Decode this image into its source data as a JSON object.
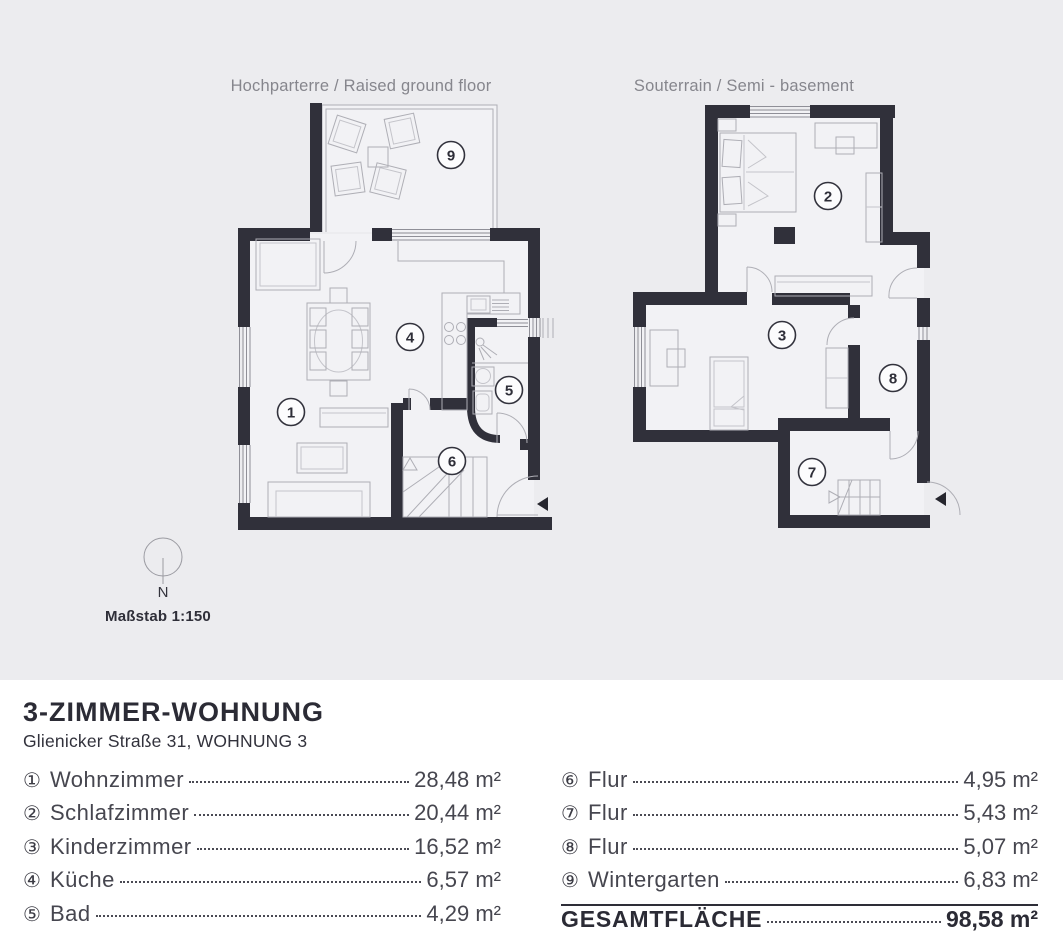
{
  "plans": {
    "p1": {
      "title": "Hochparterre / Raised ground floor",
      "badges": {
        "wohnzimmer": "1",
        "kueche": "4",
        "bad": "5",
        "flur": "6",
        "wintergarten": "9"
      }
    },
    "p2": {
      "title": "Souterrain / Semi - basement",
      "badges": {
        "schlafzimmer": "2",
        "kinderzimmer": "3",
        "flur_unten": "7",
        "flur_oben": "8"
      }
    }
  },
  "compass": {
    "label": "N"
  },
  "scale": {
    "label": "Maßstab 1:150"
  },
  "legend": {
    "title": "3-ZIMMER-WOHNUNG",
    "subtitle": "Glienicker Straße 31, WOHNUNG 3",
    "left": [
      {
        "num": "①",
        "name": "Wohnzimmer",
        "area": "28,48 m²"
      },
      {
        "num": "②",
        "name": "Schlafzimmer",
        "area": "20,44 m²"
      },
      {
        "num": "③",
        "name": "Kinderzimmer",
        "area": "16,52 m²"
      },
      {
        "num": "④",
        "name": "Küche",
        "area": "6,57 m²"
      },
      {
        "num": "⑤",
        "name": "Bad",
        "area": "4,29 m²"
      }
    ],
    "right": [
      {
        "num": "⑥",
        "name": "Flur",
        "area": "4,95 m²"
      },
      {
        "num": "⑦",
        "name": "Flur",
        "area": "5,43 m²"
      },
      {
        "num": "⑧",
        "name": "Flur",
        "area": "5,07 m²"
      },
      {
        "num": "⑨",
        "name": "Wintergarten",
        "area": "6,83 m²"
      }
    ],
    "total": {
      "label": "GESAMTFLÄCHE",
      "area": "98,58 m²"
    }
  },
  "colors": {
    "wall": "#30303a",
    "panel_bg": "#ececef",
    "room_fill": "#f2f2f5",
    "muted_text": "#86868d"
  }
}
